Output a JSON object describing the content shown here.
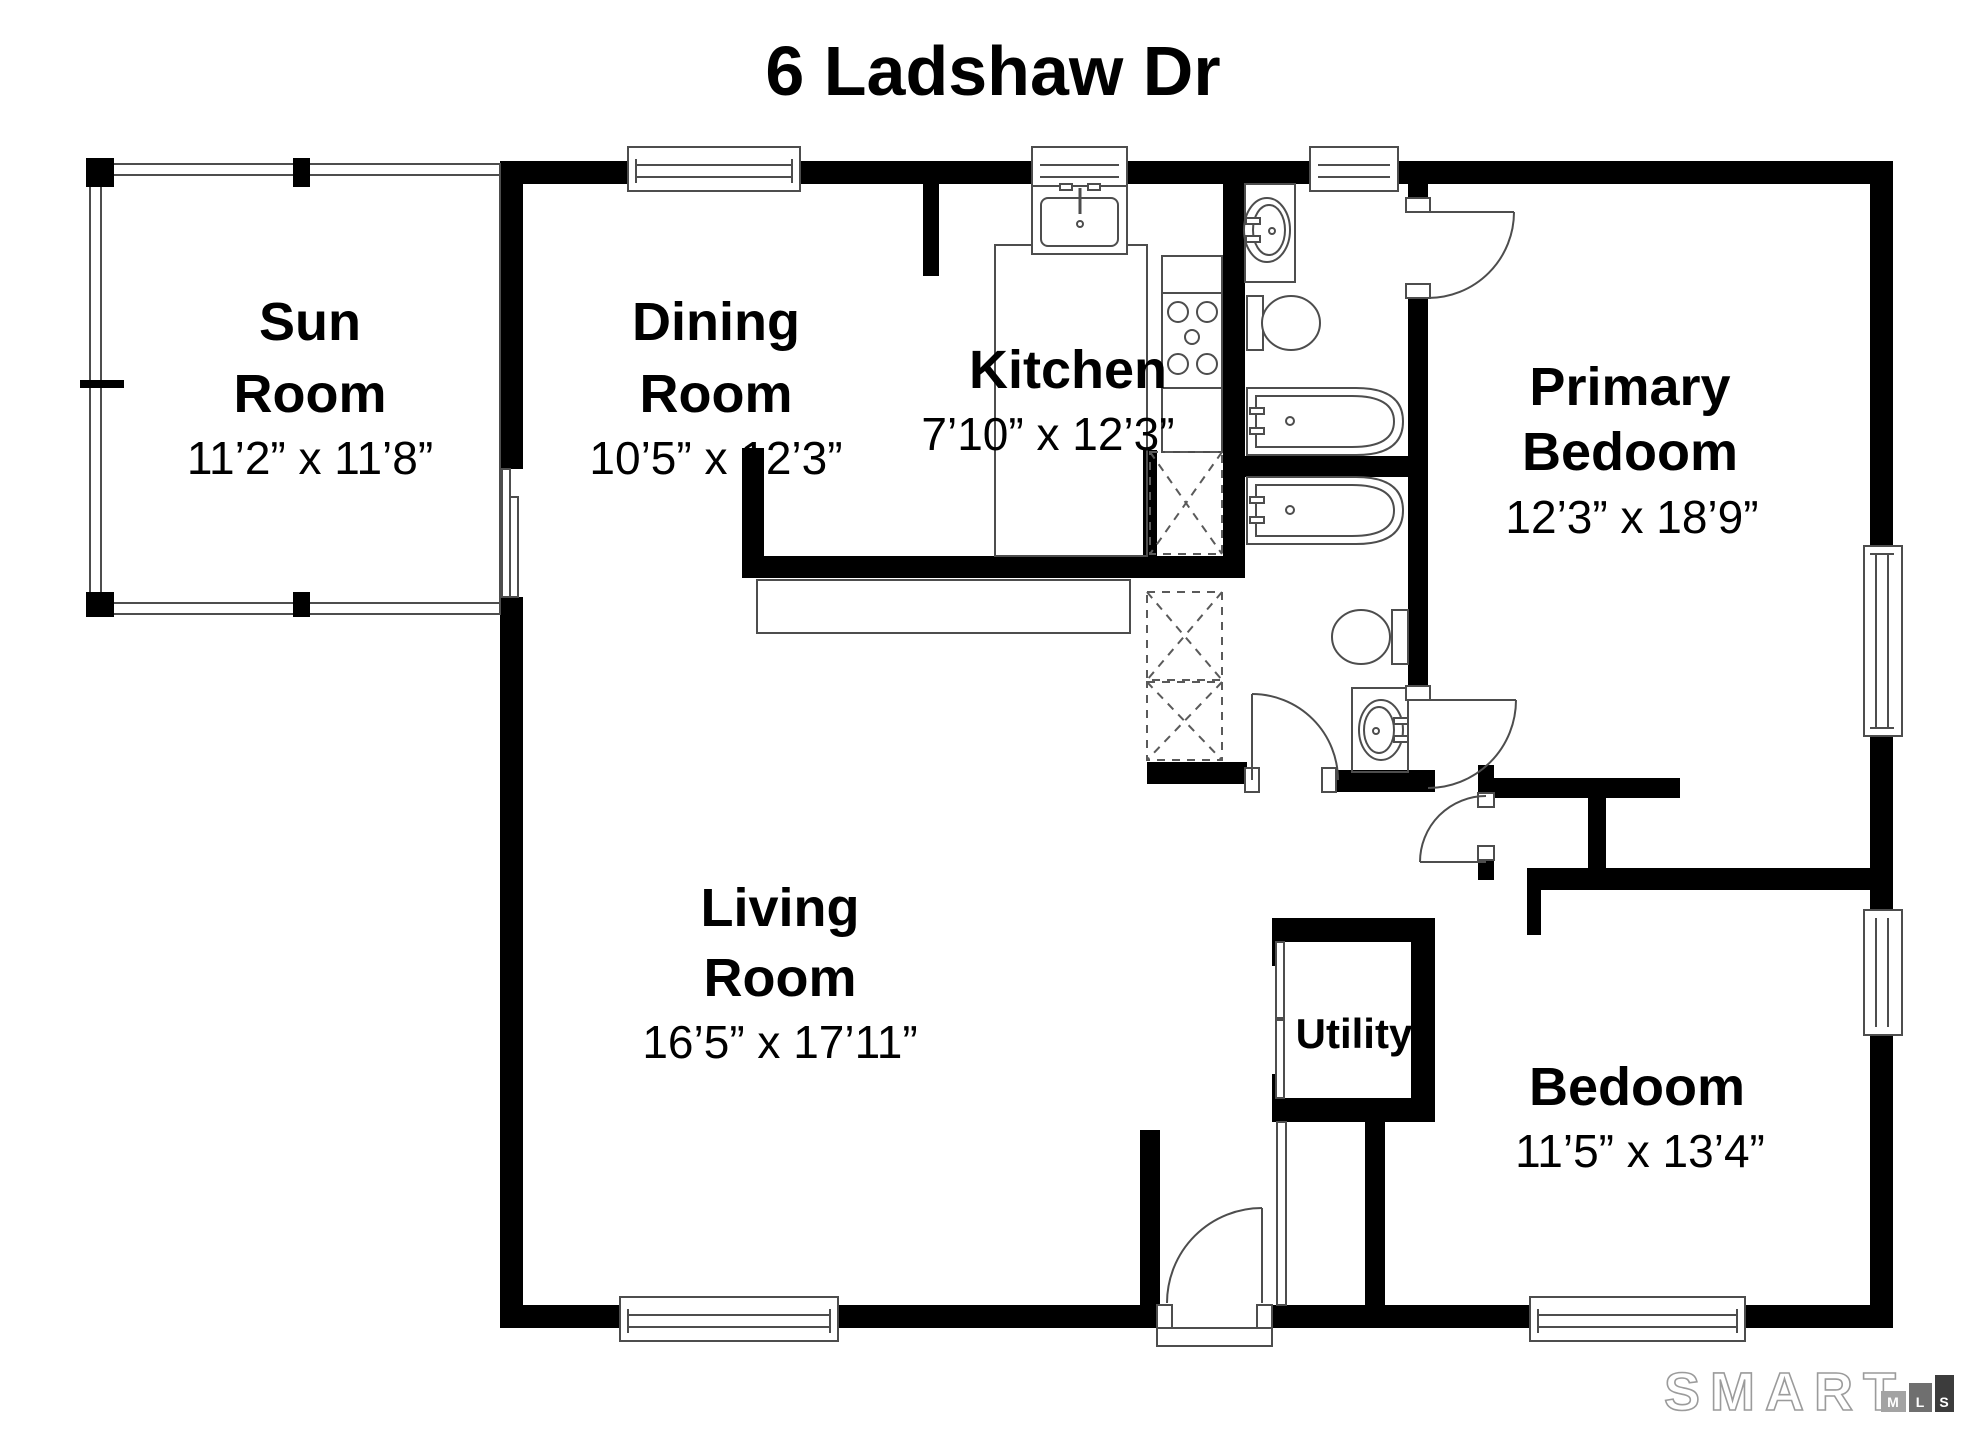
{
  "title": "6 Ladshaw Dr",
  "colors": {
    "wall": "#000000",
    "thin_line": "#4d4d4d",
    "logo_outline": "#9b9b9b",
    "logo_bar_m": "#a3a3a3",
    "logo_bar_l": "#6f6f6f",
    "logo_bar_s": "#3c3c3c"
  },
  "rooms": {
    "sun": {
      "line1": "Sun",
      "line2": "Room",
      "dims": "11’2” x 11’8”"
    },
    "dining": {
      "line1": "Dining",
      "line2": "Room",
      "dims": "10’5” x 12’3”"
    },
    "kitchen": {
      "line1": "Kitchen",
      "dims": "7’10” x 12’3”"
    },
    "primary": {
      "line1": "Primary",
      "line2": "Bedoom",
      "dims": "12’3” x 18’9”"
    },
    "living": {
      "line1": "Living",
      "line2": "Room",
      "dims": "16’5” x 17’11”"
    },
    "utility": {
      "line1": "Utility"
    },
    "bedroom": {
      "line1": "Bedoom",
      "dims": "11’5” x 13’4”"
    }
  },
  "logo": {
    "brand": "SMART",
    "bars": [
      "M",
      "L",
      "S"
    ]
  }
}
